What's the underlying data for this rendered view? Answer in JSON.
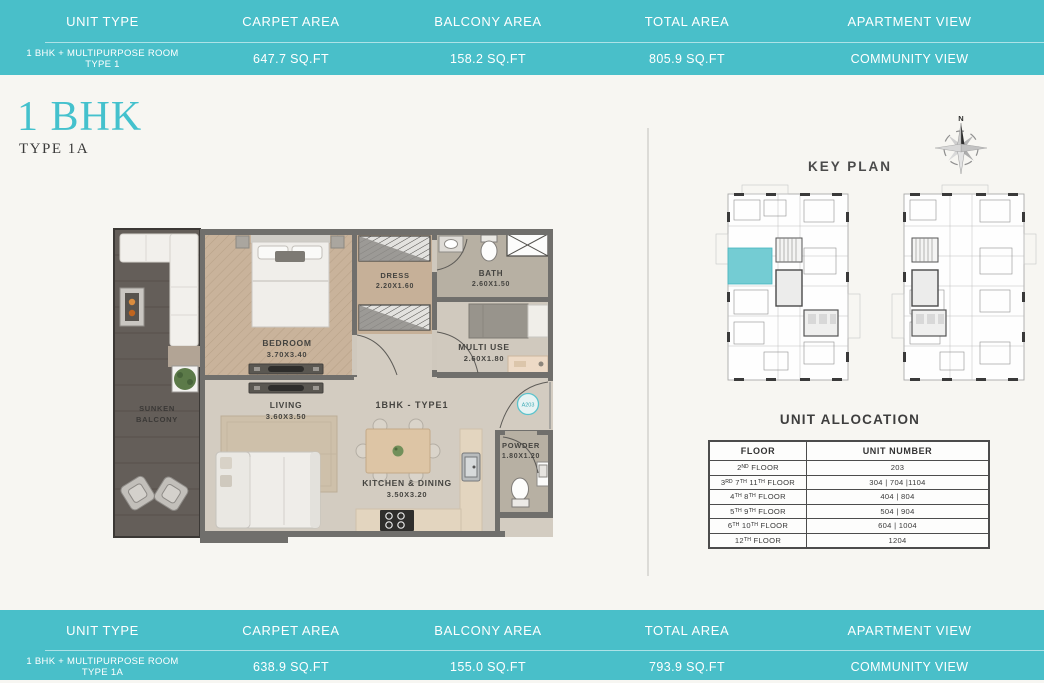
{
  "colors": {
    "teal_bar": "#49bfc9",
    "accent": "#44c1cd",
    "highlight_unit": "#74ccd3"
  },
  "top_bar": {
    "headers": [
      "UNIT TYPE",
      "CARPET AREA",
      "BALCONY AREA",
      "TOTAL AREA",
      "APARTMENT VIEW"
    ],
    "unit_type_line1": "1 BHK + MULTIPURPOSE ROOM",
    "unit_type_line2": "TYPE 1",
    "carpet_area": "647.7 SQ.FT",
    "balcony_area": "158.2 SQ.FT",
    "total_area": "805.9 SQ.FT",
    "apartment_view": "COMMUNITY VIEW"
  },
  "bottom_bar": {
    "headers": [
      "UNIT TYPE",
      "CARPET AREA",
      "BALCONY AREA",
      "TOTAL AREA",
      "APARTMENT VIEW"
    ],
    "unit_type_line1": "1 BHK + MULTIPURPOSE ROOM",
    "unit_type_line2": "TYPE 1A",
    "carpet_area": "638.9 SQ.FT",
    "balcony_area": "155.0 SQ.FT",
    "total_area": "793.9 SQ.FT",
    "apartment_view": "COMMUNITY VIEW"
  },
  "title": {
    "main": "1 BHK",
    "sub": "TYPE 1A"
  },
  "plan": {
    "unit_label": "1BHK - TYPE1",
    "unit_tag": "A203",
    "rooms": [
      {
        "name": "BEDROOM",
        "dims": "3.70X3.40"
      },
      {
        "name": "DRESS",
        "dims": "2.20X1.60"
      },
      {
        "name": "BATH",
        "dims": "2.60X1.50"
      },
      {
        "name": "MULTI USE",
        "dims": "2.60X1.80"
      },
      {
        "name": "LIVING",
        "dims": "3.60X3.50"
      },
      {
        "name": "KITCHEN & DINING",
        "dims": "3.50X3.20"
      },
      {
        "name": "POWDER",
        "dims": "1.80X1.20"
      }
    ],
    "balcony": {
      "line1": "SUNKEN",
      "line2": "BALCONY"
    }
  },
  "key_plan": {
    "title": "KEY PLAN",
    "compass_label": "N"
  },
  "unit_allocation": {
    "title": "UNIT ALLOCATION",
    "headers": [
      "FLOOR",
      "UNIT NUMBER"
    ],
    "rows": [
      {
        "floor": "2ᴺᴰ FLOOR",
        "unit": "203"
      },
      {
        "floor": "3ᴿᴰ 7ᵀᴴ 11ᵀᴴ FLOOR",
        "unit": "304 | 704 |1104"
      },
      {
        "floor": "4ᵀᴴ 8ᵀᴴ FLOOR",
        "unit": "404 | 804"
      },
      {
        "floor": "5ᵀᴴ 9ᵀᴴ FLOOR",
        "unit": "504 | 904"
      },
      {
        "floor": "6ᵀᴴ 10ᵀᴴ FLOOR",
        "unit": "604 | 1004"
      },
      {
        "floor": "12ᵀᴴ FLOOR",
        "unit": "1204"
      }
    ]
  }
}
